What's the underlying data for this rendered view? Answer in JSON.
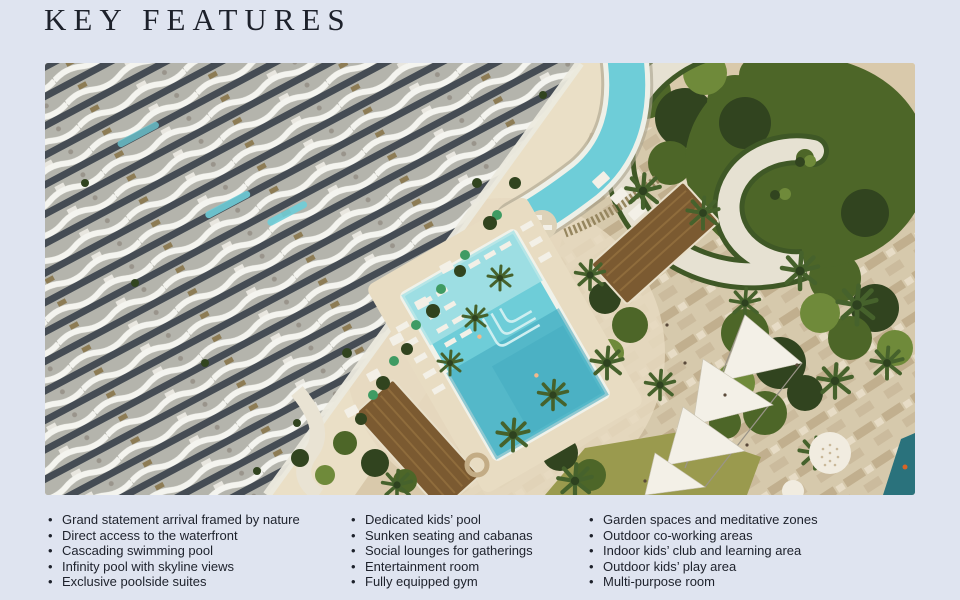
{
  "header": {
    "title": "KEY FEATURES"
  },
  "features": {
    "col1": [
      "Grand statement arrival framed by nature",
      "Direct access to the waterfront",
      "Cascading swimming pool",
      "Infinity pool with skyline views",
      "Exclusive poolside suites"
    ],
    "col2": [
      "Dedicated kids’ pool",
      "Sunken seating and cabanas",
      "Social lounges for gatherings",
      "Entertainment room",
      "Fully equipped gym"
    ],
    "col3": [
      "Garden spaces and meditative zones",
      "Outdoor co-working areas",
      "Indoor kids’ club and learning area",
      "Outdoor kids’ play area",
      "Multi-purpose room"
    ]
  },
  "palette": {
    "bg": "#dfe4f0",
    "ink": "#1d212b",
    "sand": "#d9c9ab",
    "sand-light": "#eadFC6",
    "deck": "#e6d9bf",
    "pool": "#6ecdd8",
    "pool-light": "#a9e2e6",
    "pool-deep": "#3fa8bd",
    "green": "#4d6628",
    "green-dark": "#31441f",
    "green-light": "#6f8a3a",
    "brown-roof": "#7b5a31",
    "lawn": "#9a9a4e",
    "sea": "#2a727c",
    "road": "#70706a",
    "umbrella": "#3f9b63"
  }
}
